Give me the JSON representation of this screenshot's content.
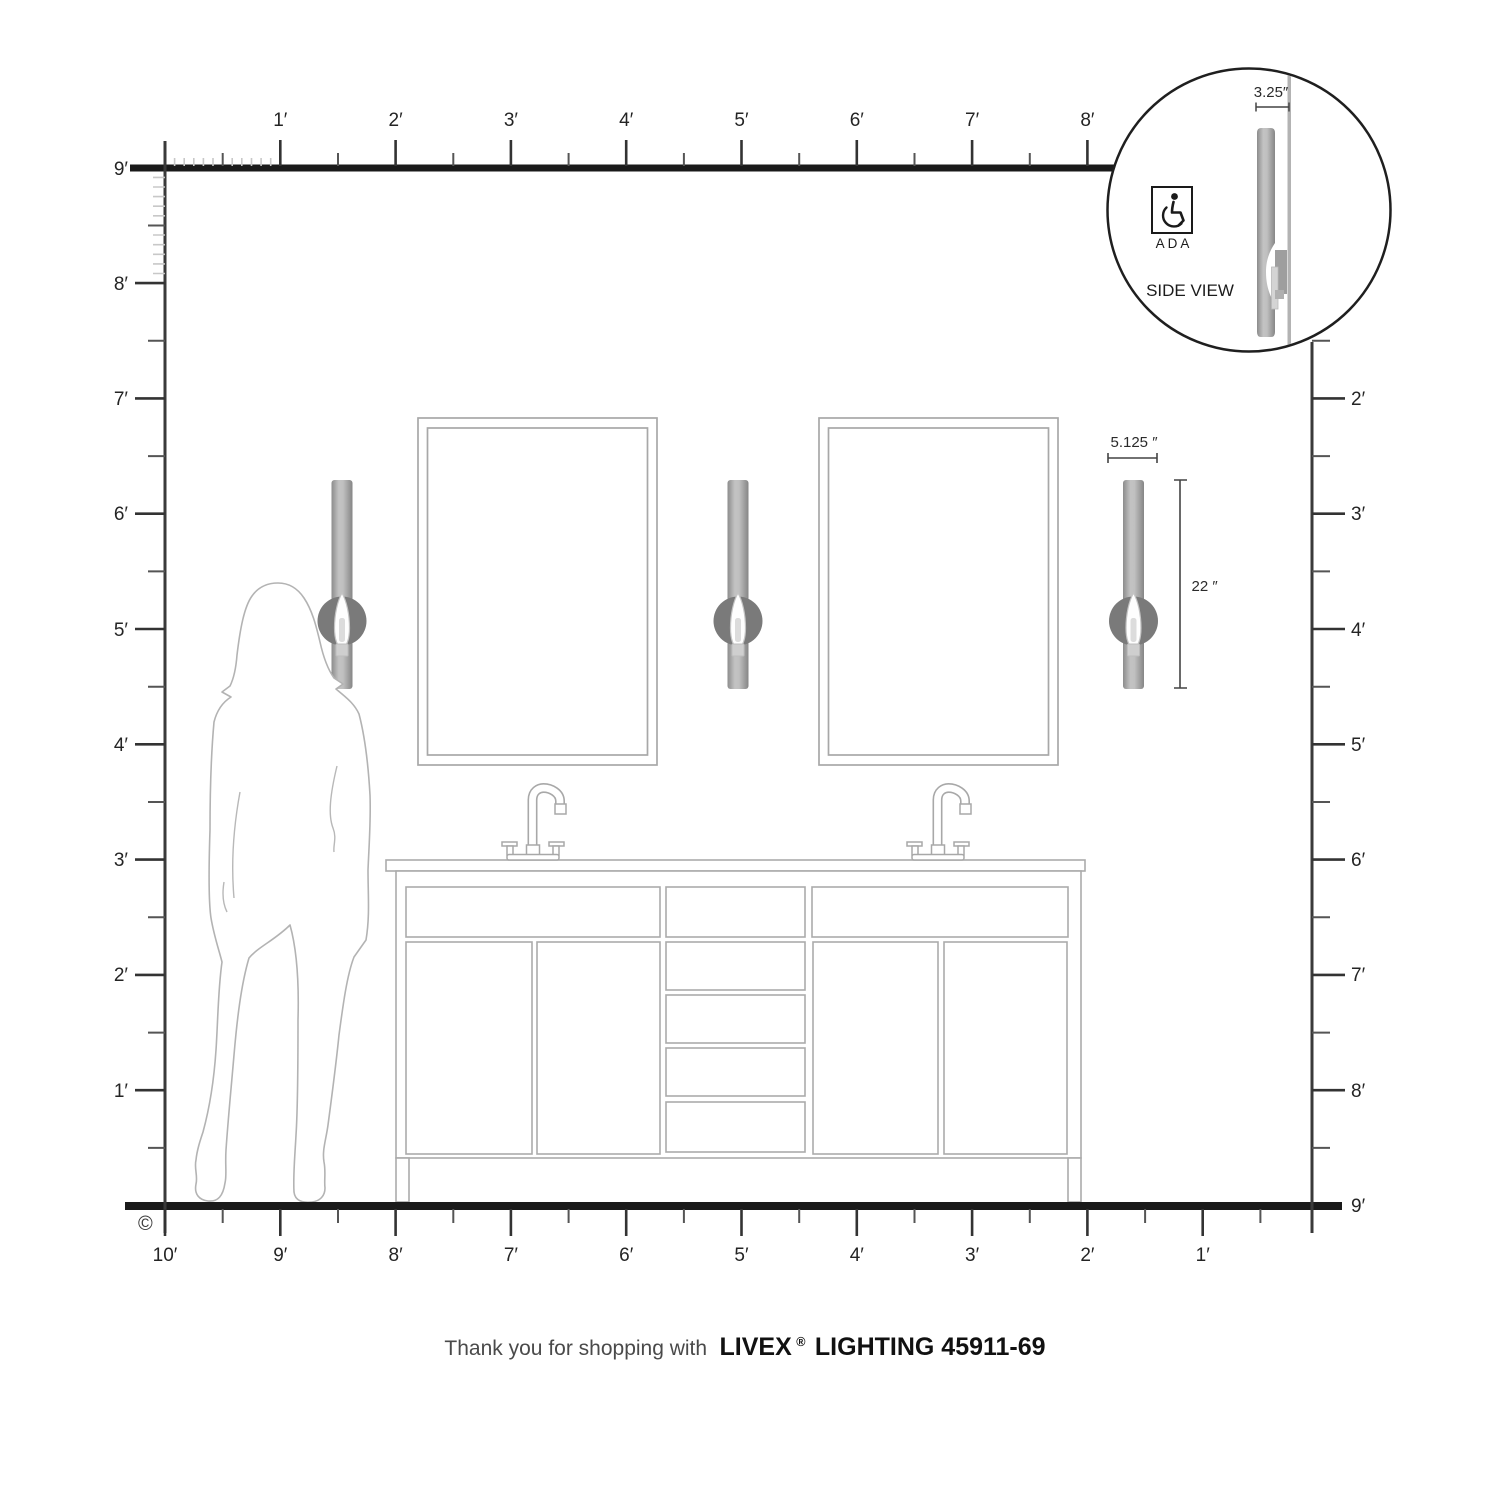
{
  "title": "Wall sconce scale diagram",
  "rulers": {
    "top": {
      "labels": [
        "1′",
        "2′",
        "3′",
        "4′",
        "5′",
        "6′",
        "7′",
        "8′"
      ]
    },
    "left": {
      "labels": [
        "9′",
        "8′",
        "7′",
        "6′",
        "5′",
        "4′",
        "3′",
        "2′",
        "1′"
      ]
    },
    "right": {
      "labels": [
        "2′",
        "3′",
        "4′",
        "5′",
        "6′",
        "7′",
        "8′",
        "9′"
      ]
    },
    "bottom": {
      "labels": [
        "10′",
        "9′",
        "8′",
        "7′",
        "6′",
        "5′",
        "4′",
        "3′",
        "2′",
        "1′"
      ]
    }
  },
  "dimensions": {
    "fixture_width": "5.125 ″",
    "fixture_height": "22 ″",
    "fixture_depth": "3.25″"
  },
  "detail": {
    "ada": "ADA",
    "side_view": "SIDE VIEW"
  },
  "copyright": "©",
  "footer": {
    "prefix": "Thank you for shopping with",
    "brand": "LIVEX",
    "registered": "®",
    "suffix": "LIGHTING 45911-69"
  },
  "colors": {
    "ink": "#1f1f1f",
    "tick_major": "#333333",
    "tick_minor": "#c8c8c8",
    "fixture_outline": "#a8a8a8",
    "sconce_metal": "#9a9a9a",
    "sconce_backplate": "#7a7a7a",
    "silhouette_outline": "#b3b3b3"
  }
}
